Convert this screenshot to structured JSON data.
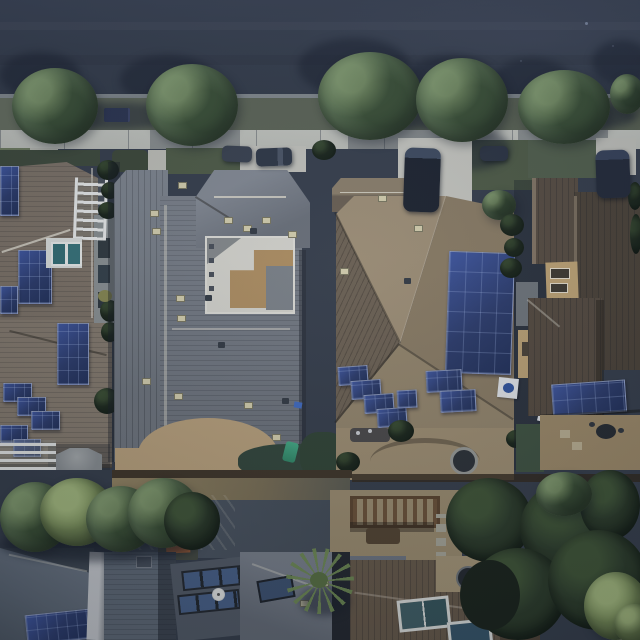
{
  "meta": {
    "title": "Aerial drone view of a suburban neighborhood street with rooftop solar panels",
    "view": "top-down daytime aerial photograph"
  },
  "scene": {
    "street": {
      "label": "asphalt street at top of frame"
    },
    "sidewalk": {
      "label": "concrete sidewalk with grass parkway and street trees"
    },
    "street_trees_count": 6,
    "vehicles": [
      {
        "label": "blue sedan parked on street"
      },
      {
        "label": "dark van parked in driveway"
      },
      {
        "label": "dark van parked far-right driveway"
      },
      {
        "label": "dark cars parked at curb"
      }
    ],
    "houses_front_row": [
      {
        "label": "left house with tan roof and many solar panels",
        "solar_panels": true,
        "features": [
          "white trellis",
          "teal spa",
          "patio umbrella",
          "white slat fence"
        ]
      },
      {
        "label": "center house with large gray roof and interior courtyard",
        "solar_panels": false,
        "features": [
          "white paved courtyard",
          "tan patio",
          "dark green lawn",
          "green slide"
        ]
      },
      {
        "label": "right house with tan hip roof and large solar arrays",
        "solar_panels": true,
        "features": [
          "stepped solar panels",
          "backyard fire pit",
          "curved patio"
        ]
      },
      {
        "label": "far right house with dark brown roof and solar array",
        "solar_panels": true
      }
    ],
    "houses_back_row": [
      {
        "label": "bottom-left house with blue-gray roof and solar panel",
        "solar_panels": true
      },
      {
        "label": "bottom-center house with skylights, satellite dish and palm tree"
      },
      {
        "label": "bottom-right house with brown roof and skylights"
      }
    ],
    "vegetation": [
      "street trees along parkway",
      "backyard tree row",
      "large dark trees bottom right",
      "palm tree",
      "light green corner tree",
      "property-line hedges"
    ],
    "misc": [
      "orange play structure",
      "wood pergola",
      "fire pit",
      "white spa covers",
      "trash bins"
    ]
  },
  "colors": {
    "road": "#363e4c",
    "sidewalk": "#c0c2ba",
    "parkway_grass": "#5e6655",
    "lawn": "#4e5c44",
    "lawn_dark": "#31463a",
    "tree_green": "#5a7350",
    "tree_dark": "#39492f",
    "roof_tan_left": "#7f7466",
    "roof_gray": "#757b85",
    "roof_gray_light": "#868c96",
    "roof_tan": "#97876b",
    "roof_tan_shadow": "#6e6252",
    "roof_brown": "#584d40",
    "roof_brown_dark": "#4c4337",
    "roof_bluegray": "#5c6876",
    "solar_blue": "#2b3c70",
    "solar_blue_light": "#3e57a6",
    "paving_tan": "#bda37a",
    "paving_light": "#d8d7cf",
    "concrete": "#c6c6be",
    "white_trim": "#eef0ee",
    "water_teal": "#2f6f75",
    "umbrella_gray": "#8b9093",
    "orange_equipment": "#bf6a33",
    "wood_brown": "#6e5236"
  }
}
